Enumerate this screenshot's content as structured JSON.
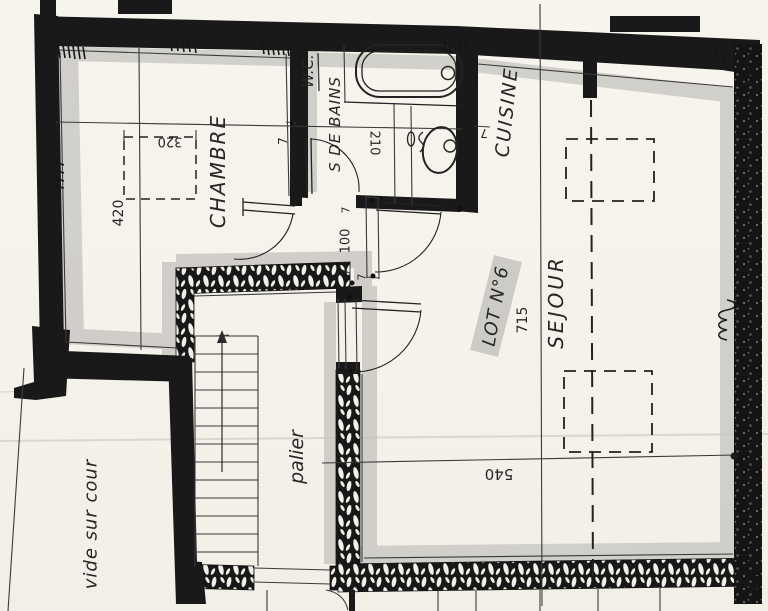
{
  "plan": {
    "lot_label": "LOT N°6",
    "rooms": {
      "chambre": "CHAMBRE",
      "wc": "W.C.",
      "salle_de_bains": "S DE BAINS",
      "cuisine": "CUISINE",
      "sejour": "SEJOUR",
      "palier": "palier",
      "vide_sur_cour": "vide sur cour"
    },
    "dimensions": {
      "chambre_length": "420",
      "placard_width": "320",
      "sdb_width": "210",
      "door_width": "100",
      "sejour_length": "715",
      "sejour_width": "540",
      "wall_wc": "7",
      "wall_cuisine": "7",
      "wall_door_top": "7",
      "wall_door_bottom": "7",
      "wall_palier": "7"
    },
    "colors": {
      "paper": "#f6f3ec",
      "ink": "#1c1c1c",
      "shadow_grey": "#c7c5c0",
      "highlight_grey": "#c9c7c2"
    }
  }
}
